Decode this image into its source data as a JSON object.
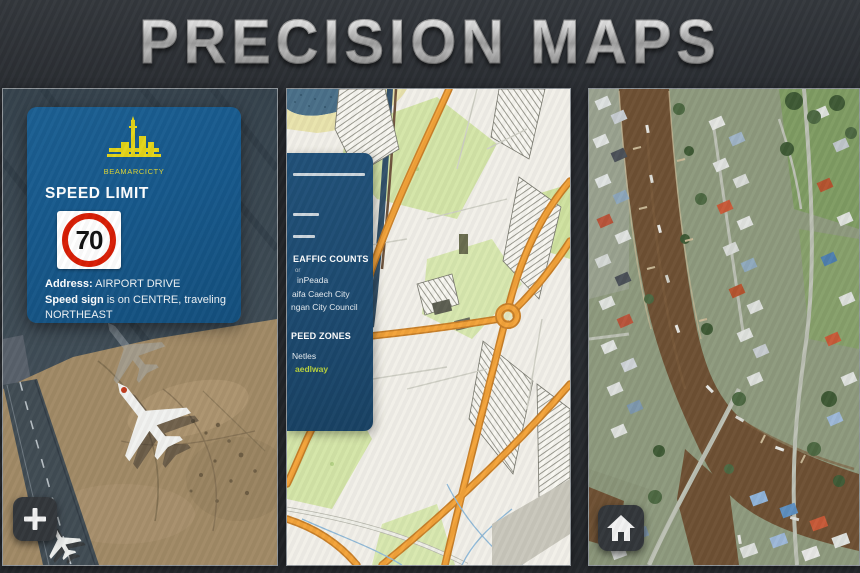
{
  "title": "PRECISION MAPS",
  "left_panel": {
    "card": {
      "logo_label": "BEAMARCICTY",
      "heading": "SPEED LIMIT",
      "speed_value": "70",
      "address_label": "Address:",
      "address_value": " AIRPORT DRIVE",
      "direction_label": "Speed sign",
      "direction_rest": " is on CENTRE, traveling",
      "direction_line2": "NORTHEAST"
    },
    "zoom_button_icon": "plus-icon"
  },
  "middle_panel": {
    "sidebar": {
      "section1_title": "EAFFIC COUNTS",
      "section1_note": "or",
      "section1_items": [
        "inPeada",
        "aifa Caech City",
        "ngan City Council"
      ],
      "section2_title": "PEED ZONES",
      "section2_items": [
        "Netles"
      ],
      "section2_highlight": "aedlway"
    }
  },
  "right_panel": {
    "home_button_icon": "home-icon"
  },
  "colors": {
    "card_blue": "#17598c",
    "sidebar_blue": "#1d4a70",
    "sign_red": "#d81e05",
    "highlight_green": "#b9d23c",
    "motorway_orange": "#f3a33a",
    "title_silver": "#c8c8c8"
  }
}
